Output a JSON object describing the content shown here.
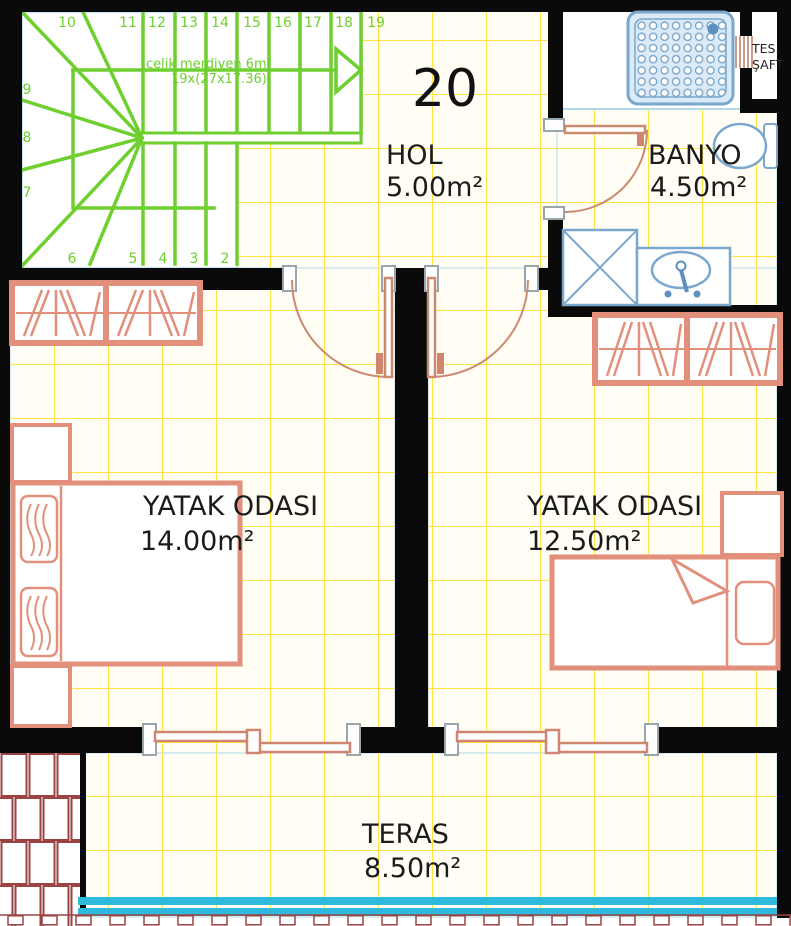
{
  "plan": {
    "unit_label": "20",
    "rooms": [
      {
        "name": "HOL",
        "area": "5.00m²"
      },
      {
        "name": "BANYO",
        "area": "4.50m²"
      },
      {
        "name": "YATAK ODASI",
        "area": "14.00m²"
      },
      {
        "name": "YATAK ODASI",
        "area": "12.50m²"
      },
      {
        "name": "TERAS",
        "area": "8.50m²"
      }
    ],
    "stair": {
      "note1": "celik merdiven 6m²",
      "note2": "19x(27x17.36)",
      "top_steps": [
        "10",
        "11",
        "12",
        "13",
        "14",
        "15",
        "16",
        "17",
        "18",
        "19"
      ],
      "left_steps": [
        "9",
        "8",
        "7"
      ],
      "bottom_steps": [
        "6",
        "5",
        "4",
        "3",
        "2"
      ]
    },
    "shaft": {
      "line1": "TES.",
      "line2": "ŞAFT"
    },
    "colors": {
      "stair_green": "#6ecf2e",
      "grid_yellow": "#ffe33e",
      "furniture_salmon": "#e2907c",
      "fixture_blue": "#7aa7cd",
      "railing_cyan": "#2fb9dc",
      "roof_red": "#9b4343",
      "wall_black": "#0a0a0a"
    }
  }
}
